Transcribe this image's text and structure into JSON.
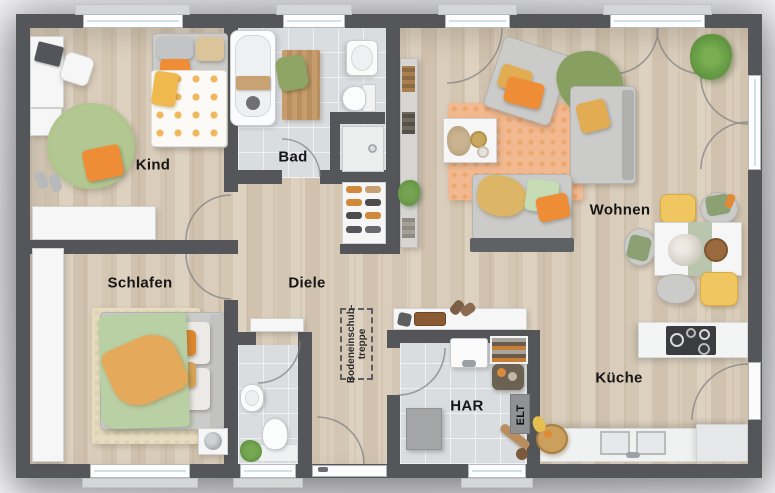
{
  "plan": {
    "rooms": {
      "kind": {
        "label": "Kind"
      },
      "bad": {
        "label": "Bad"
      },
      "wohnen": {
        "label": "Wohnen"
      },
      "schlafen": {
        "label": "Schlafen"
      },
      "diele": {
        "label": "Diele"
      },
      "har": {
        "label": "HAR"
      },
      "elt": {
        "label": "ELT"
      },
      "kueche": {
        "label": "Küche"
      }
    },
    "annotations": {
      "attic_ladder": {
        "line1": "Bodeneinschub-",
        "line2": "treppe"
      }
    },
    "palette": {
      "wall": "#54565a",
      "wood_floor": "#d6c9b6",
      "tile_floor": "#dadde0",
      "accent_orange": "#ec8b33",
      "accent_mustard": "#e9b95e",
      "accent_green": "#8aa164",
      "rug_salmon": "#f2b88f",
      "rug_kind_green": "#a9c188"
    }
  }
}
